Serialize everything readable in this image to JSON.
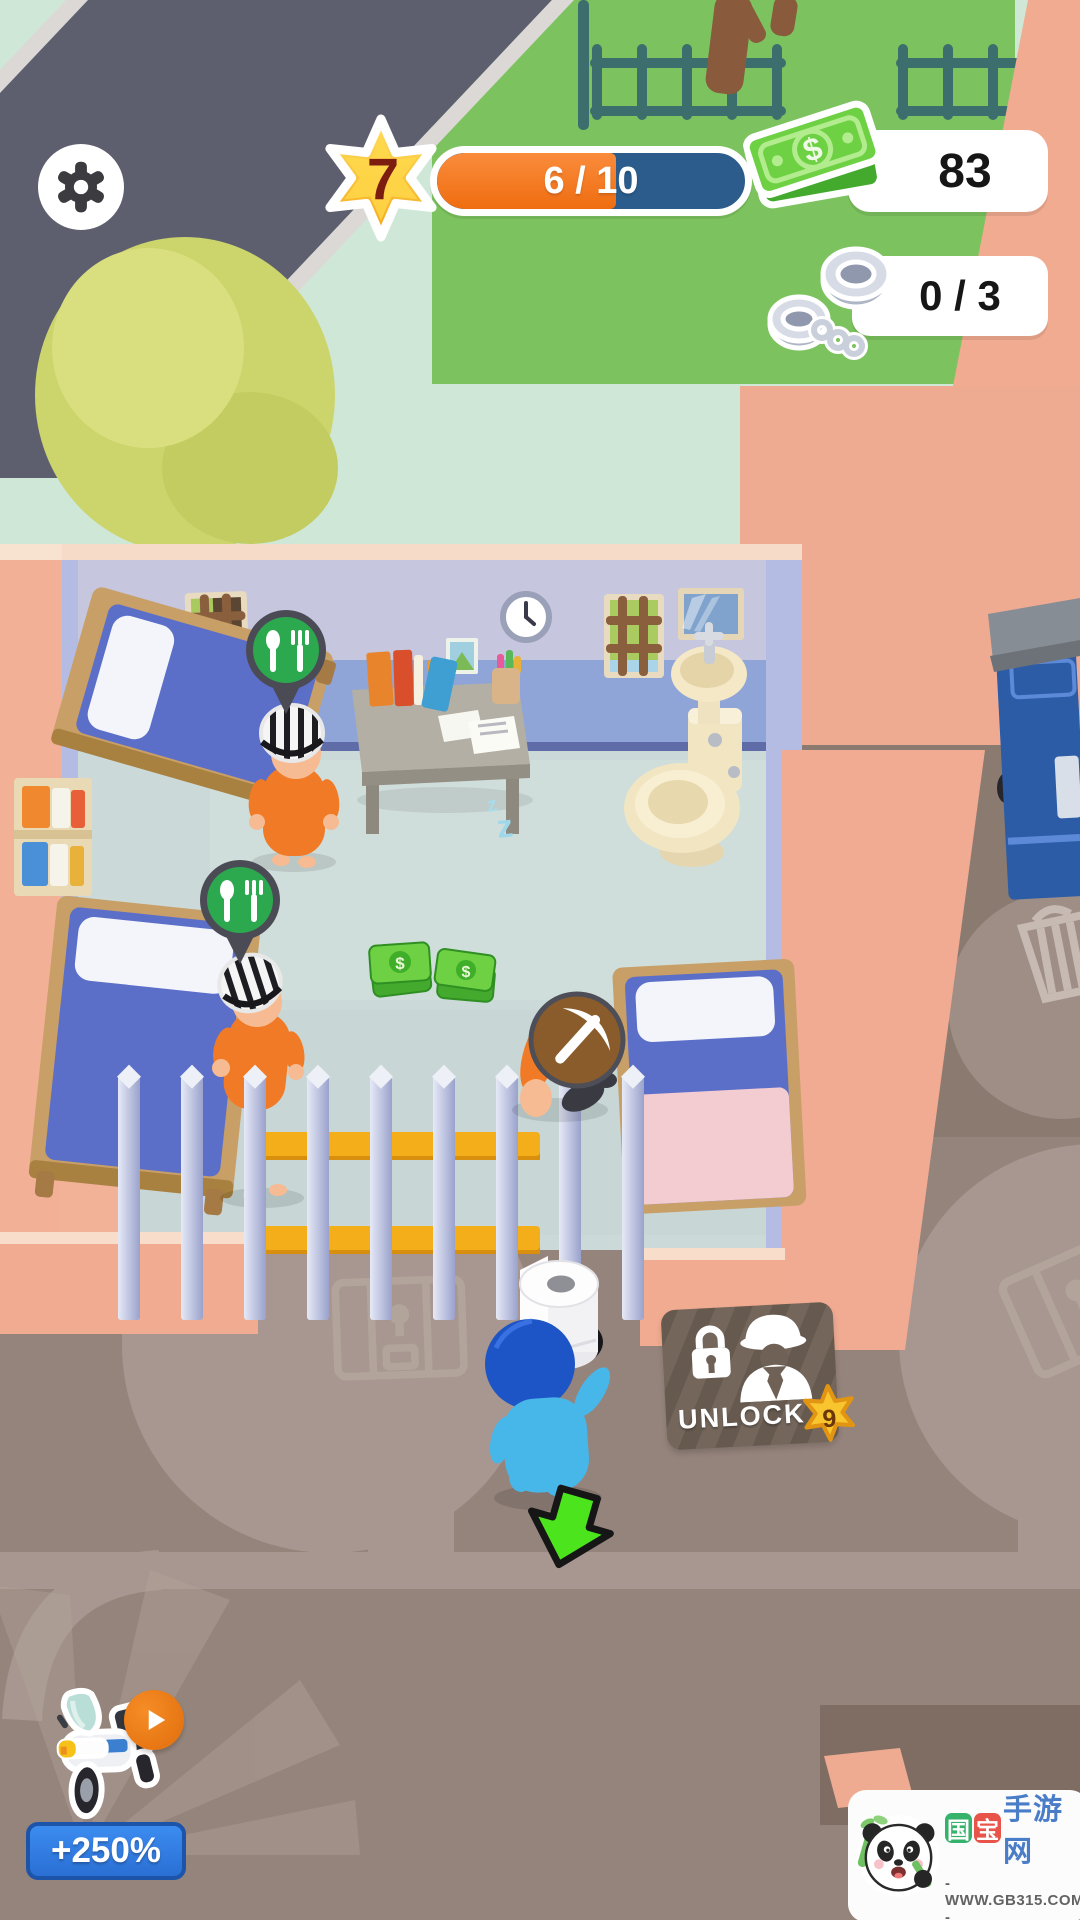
{
  "hud": {
    "settings": {
      "icon": "gear-icon"
    },
    "level": {
      "value": "7",
      "progress_label": "6 / 10",
      "progress_percent": 58,
      "star_color": "#f6b51e",
      "bar_color": "#2b5c8b",
      "fill_color": "#f errors"
    },
    "money": {
      "value": "83",
      "icon": "cash-stack-icon",
      "color": "#6ed143"
    },
    "captures": {
      "value": "0 / 3",
      "icon": "handcuffs-icon"
    }
  },
  "room": {
    "food_pins": {
      "icon": "fork-spoon-pin-icon",
      "color": "#2ca84e",
      "count": 2
    },
    "mining_badge": {
      "icon": "pickaxe-icon",
      "color": "#8a5c2b"
    },
    "prisoner_color": "#f17a26",
    "player_color": "#47b7ea"
  },
  "unlock_sign": {
    "label": "UNLOCK",
    "required_level": "9",
    "icon": "police-officer-lock-icon",
    "star_color": "#f8c52e"
  },
  "tutorial_arrow": {
    "icon": "down-arrow-icon",
    "color": "#4be41d"
  },
  "booster": {
    "bonus_label": "+250%",
    "icon": "police-motorcycle-icon",
    "action_icon": "play-icon",
    "button_color": "#2f7fe3"
  },
  "watermark": {
    "logo": "panda-logo",
    "brand_char_1": "国",
    "brand_char_2": "宝",
    "brand_suffix": "手游网",
    "site_url": "- WWW.GB315.COM -"
  },
  "decor": {
    "dollar_symbol": "$",
    "sleep_symbol": "z"
  },
  "colors": {
    "road": "#5d5f6e",
    "grass": "#7cc35f",
    "sidewalk_mint": "#cfe7d6",
    "wall_salmon": "#f0ab90",
    "room_floor": "#cbd9d8",
    "wall_lavender": "#c6c6de",
    "wall_blue": "#8fa5d8",
    "ground_taupe": "#95847c",
    "path_light": "#a79790",
    "money_green": "#6ed143"
  }
}
